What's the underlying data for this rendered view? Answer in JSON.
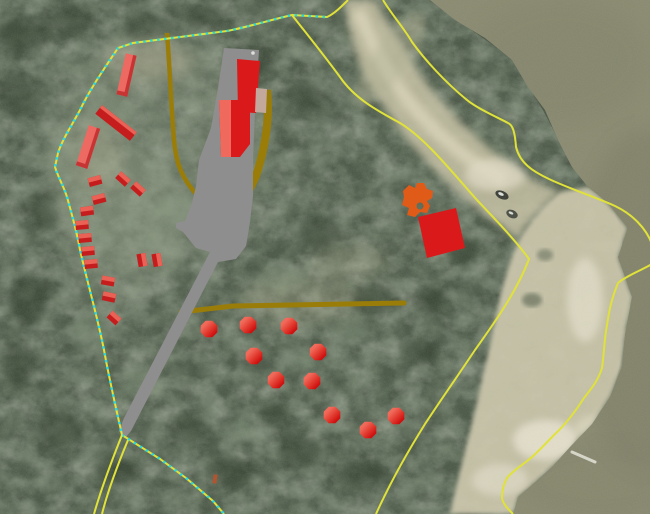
{
  "meta": {
    "type": "gis-aerial-map",
    "width": 650,
    "height": 514
  },
  "colors": {
    "boundary_yellow": "#e0e23a",
    "survey_cyan": "#2ed7d7",
    "trail_olive": "#9a7d08",
    "road_gray": "#8e8e8e",
    "building_red": "#da1a1a",
    "building_red_dark": "#c73434",
    "building_coral": "#ec6a62",
    "building_light_band": "#ef6a5c",
    "shed_light": "#ea6156",
    "shed_dark": "#c51d1d",
    "tan_roof": "#c2a99b",
    "site_orange": "#e05a18",
    "orange_brown": "#b05530",
    "hex_light": "#f06a5a",
    "hex_dark": "#cf1111",
    "water": "#8b8b72",
    "sand": "#cdc8ad",
    "forest_base": "#4e5a4a"
  },
  "features": {
    "trails": [
      {
        "name": "trail-upper-west",
        "d": "M167,33 C170,70 171,105 174,140 C176,165 183,180 198,196",
        "width": 4.5,
        "round": false
      },
      {
        "name": "trail-upper-east",
        "d": "M267,90 C270,115 266,146 256,176 C248,194 242,202 236,208",
        "width": 8,
        "round": false
      },
      {
        "name": "trail-mid-horizontal",
        "d": "M181,312 L233,306 L404,303",
        "width": 5,
        "round": true
      }
    ],
    "road": {
      "name": "gravel-road-and-parking",
      "d": "M224,48 L259,50 L255,112 L253,160 L253,196 L250,222 L246,246 L236,259 L218,262 L131,431 L125,438 L119,431 L124,418 L210,252 L196,248 L183,232 L176,228 L176,223 L185,221 L192,203 L196,186 L199,160 L211,128 L218,88 Z"
    },
    "boundaries": [
      {
        "name": "parcel-boundary-west",
        "d": "M348,0 C341,7 334,14 327,17 L292,15 C270,20 248,27 227,31 L133,43 L118,48 C104,69 90,89 80,110 C72,125 62,140 58,153 L55,167 C58,177 64,187 67,197 C72,215 77,232 80,250 C88,285 97,315 104,350 C109,378 116,408 122,435",
        "dashed": false
      },
      {
        "name": "survey-dashed-west",
        "d": "M325,17 L292,15 C270,20 248,27 227,31 L133,43 L118,48 C104,69 90,89 80,110 C72,125 62,140 58,153 L55,167 C58,177 64,187 67,197 C72,215 77,232 80,250 C88,285 97,315 104,350 C109,378 116,408 122,435",
        "dashed": true,
        "hide_yellow": true
      },
      {
        "name": "parcel-boundary-southeast",
        "d": "M122,435 L160,459 L186,478 L213,501 L224,514",
        "dashed": true
      },
      {
        "name": "access-track-west-1",
        "d": "M122,435 C112,460 102,486 94,514",
        "dashed": false
      },
      {
        "name": "access-track-west-2",
        "d": "M128,440 C118,464 108,490 102,514",
        "dashed": false
      },
      {
        "name": "parcel-boundary-inner-diagonal",
        "d": "M292,15 C302,28 320,50 340,77 C355,99 378,111 400,123 C425,138 452,172 477,200 C495,219 517,242 529,259 C517,291 495,322 475,350 C455,380 440,401 425,424 C410,448 391,481 376,514",
        "dashed": false
      },
      {
        "name": "parcel-boundary-northeast",
        "d": "M383,0 C392,15 404,28 412,42 C425,60 445,82 467,100 C478,109 497,117 508,123 C513,125 515,133 516,147 C520,163 532,171 549,179 C570,189 598,198 615,206 C632,214 646,228 652,244",
        "dashed": false
      },
      {
        "name": "parcel-boundary-shoreline",
        "d": "M652,264 C640,271 626,276 618,283 C611,300 609,312 607,325 C604,341 604,355 602,368 C598,381 591,389 584,398 C575,412 566,424 555,434 C547,442 540,450 532,457 C523,465 513,470 507,478 C503,485 502,491 502,498 C503,504 508,509 513,514",
        "dashed": false
      }
    ],
    "buildings": {
      "main_complex": [
        {
          "points": "219,100 250,100 250,144 240,157 221,157",
          "fill": "building_red"
        },
        {
          "points": "219,100 231,100 231,157 221,157",
          "fill": "building_light_band"
        },
        {
          "points": "237,59 260,61 256,113 238,112",
          "fill": "building_red"
        },
        {
          "points": "256,88 267,89 266,113 255,112",
          "fill": "tan_roof"
        }
      ],
      "vent_dot": {
        "cx": 253,
        "cy": 53,
        "r": 1.8,
        "fill": "#e0e0da"
      },
      "coral": [
        {
          "cx": 126.5,
          "cy": 75,
          "w": 11,
          "h": 42,
          "angle": 13
        },
        {
          "cx": 88,
          "cy": 147,
          "w": 12,
          "h": 42,
          "angle": 18
        }
      ],
      "bar": {
        "cx": 116,
        "cy": 123,
        "w": 44,
        "h": 11,
        "angle": 38
      },
      "sheds": [
        {
          "cx": 95,
          "cy": 181,
          "w": 13,
          "h": 9,
          "angle": -15
        },
        {
          "cx": 123,
          "cy": 179,
          "w": 13,
          "h": 9,
          "angle": 42
        },
        {
          "cx": 138,
          "cy": 189,
          "w": 13,
          "h": 9,
          "angle": 42
        },
        {
          "cx": 99,
          "cy": 199,
          "w": 13,
          "h": 9,
          "angle": -15
        },
        {
          "cx": 87,
          "cy": 211,
          "w": 13,
          "h": 9,
          "angle": -8
        },
        {
          "cx": 82,
          "cy": 225,
          "w": 13,
          "h": 9,
          "angle": -5
        },
        {
          "cx": 85,
          "cy": 238,
          "w": 13,
          "h": 9,
          "angle": -5
        },
        {
          "cx": 88,
          "cy": 251,
          "w": 13,
          "h": 9,
          "angle": -5
        },
        {
          "cx": 91,
          "cy": 264,
          "w": 13,
          "h": 9,
          "angle": -5
        },
        {
          "cx": 108,
          "cy": 281,
          "w": 13,
          "h": 9,
          "angle": 10
        },
        {
          "cx": 142,
          "cy": 260,
          "w": 13,
          "h": 9,
          "angle": 80
        },
        {
          "cx": 157,
          "cy": 260,
          "w": 13,
          "h": 9,
          "angle": 80
        },
        {
          "cx": 109,
          "cy": 297,
          "w": 13,
          "h": 9,
          "angle": 12
        },
        {
          "cx": 114,
          "cy": 318,
          "w": 12,
          "h": 9,
          "angle": 42
        }
      ],
      "southeast_building": {
        "points": "418,217 456,208 465,248 427,258"
      }
    },
    "site_markers": {
      "hexagons": {
        "radius": 9,
        "centers": [
          [
            209,
            329
          ],
          [
            248,
            325
          ],
          [
            289,
            326
          ],
          [
            254,
            356
          ],
          [
            318,
            352
          ],
          [
            276,
            380
          ],
          [
            312,
            381
          ],
          [
            332,
            415
          ],
          [
            368,
            430
          ],
          [
            396,
            416
          ]
        ]
      }
    },
    "orange_marker": {
      "d": "M403,191 L409,185 L415,188 L417,183 L424,183 L427,189 L433,191 L432,198 L427,201 L430,206 L427,213 L420,212 L415,217 L407,215 L409,208 L402,205 L404,197 Z M423.5,206 a3.5,3.5 0 1,0 -7,0 a3.5,3.5 0 1,0 7,0 Z"
    },
    "orange_dash": {
      "cx": 215,
      "cy": 479,
      "w": 4,
      "h": 9,
      "angle": 8
    }
  }
}
